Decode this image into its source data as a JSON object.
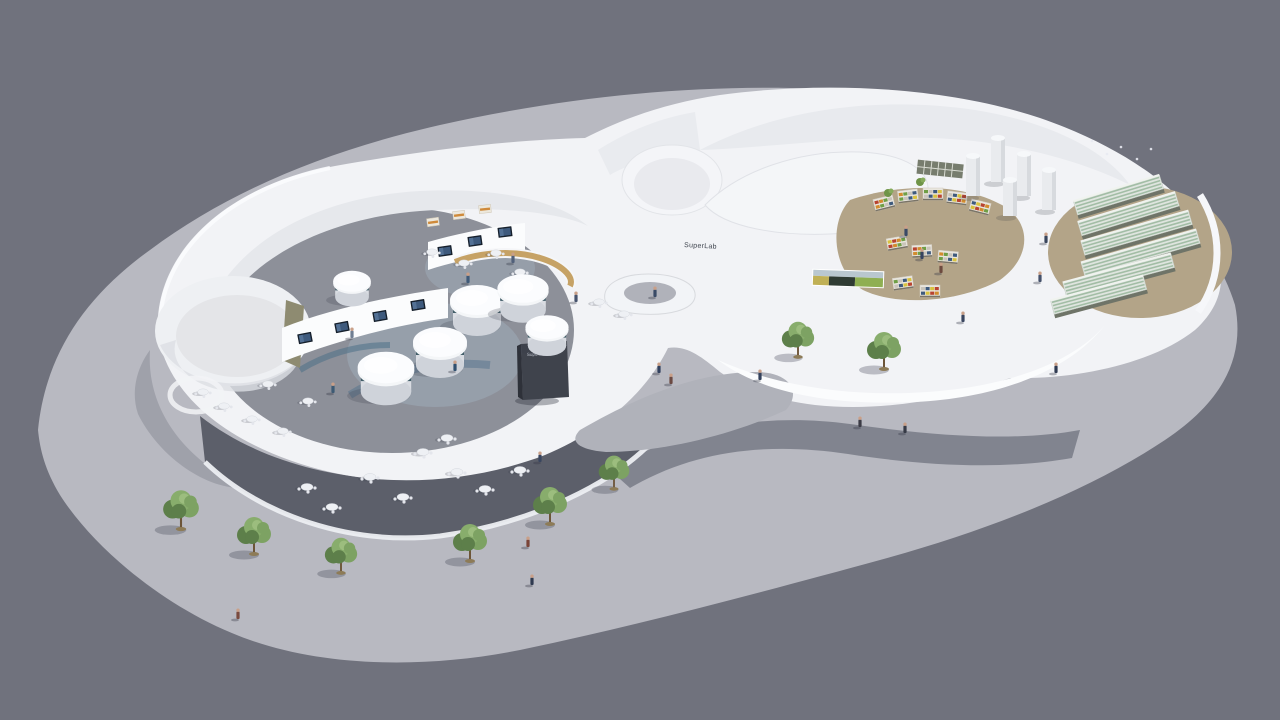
{
  "scene": {
    "title": "SuperLab pavilion aerial 3D render",
    "labels": {
      "building_wall_text": "SuperLab",
      "entrance_sign_text": "SuperLab"
    },
    "colors": {
      "background": "#70727d",
      "plaza": "#b8b9c1",
      "building_white": "#f2f3f6",
      "building_shade": "#e7e9ed",
      "courtyard_floor": "#8d9099",
      "forecourt_floor": "#b0b2ba",
      "terrace_dark": "#5c5f6a",
      "walkway_dark": "#7b7e89",
      "store_floor_tan": "#b3a488",
      "pod_band_teal": "#415d68",
      "screen_dark": "#16202c",
      "screen_glow": "#3e5a7d",
      "tree_green": "#7da263",
      "tree_green_dark": "#5d7f4a",
      "billboard_sky": "#b9c7cf",
      "billboard_dark": "#2f3b33",
      "billboard_green": "#8faf52",
      "billboard_yellow": "#c0b055",
      "wood_counter": "#c6a265",
      "olive_panel": "#8e8b71",
      "sign_face": "#3f434c"
    },
    "objects": {
      "trees": [
        {
          "x": 181,
          "y": 528,
          "s": 1.05
        },
        {
          "x": 254,
          "y": 553,
          "s": 1.0
        },
        {
          "x": 341,
          "y": 572,
          "s": 0.95
        },
        {
          "x": 470,
          "y": 560,
          "s": 1.0
        },
        {
          "x": 550,
          "y": 523,
          "s": 1.0
        },
        {
          "x": 614,
          "y": 488,
          "s": 0.9
        },
        {
          "x": 798,
          "y": 356,
          "s": 0.95
        },
        {
          "x": 884,
          "y": 368,
          "s": 1.0
        }
      ],
      "people": [
        {
          "x": 659,
          "y": 373,
          "c": "#31405e"
        },
        {
          "x": 671,
          "y": 384,
          "c": "#6b4a43"
        },
        {
          "x": 760,
          "y": 380,
          "c": "#33415c"
        },
        {
          "x": 860,
          "y": 427,
          "c": "#3b3b45"
        },
        {
          "x": 455,
          "y": 371,
          "c": "#305070"
        },
        {
          "x": 528,
          "y": 547,
          "c": "#7a4438"
        },
        {
          "x": 532,
          "y": 585,
          "c": "#2f3a50"
        },
        {
          "x": 238,
          "y": 619,
          "c": "#7a4a3e"
        },
        {
          "x": 1056,
          "y": 373,
          "c": "#2f3a52"
        },
        {
          "x": 905,
          "y": 433,
          "c": "#363a46"
        },
        {
          "x": 333,
          "y": 393,
          "c": "#3d5a74"
        },
        {
          "x": 352,
          "y": 338,
          "c": "#6f7e92"
        },
        {
          "x": 468,
          "y": 283,
          "c": "#3f5a78"
        },
        {
          "x": 513,
          "y": 263,
          "c": "#51607a"
        },
        {
          "x": 576,
          "y": 302,
          "c": "#46536d"
        },
        {
          "x": 655,
          "y": 297,
          "c": "#394a66"
        },
        {
          "x": 922,
          "y": 259,
          "c": "#36435f"
        },
        {
          "x": 941,
          "y": 273,
          "c": "#6d4a3f"
        },
        {
          "x": 906,
          "y": 236,
          "c": "#3a4a66"
        },
        {
          "x": 1046,
          "y": 243,
          "c": "#39455c"
        },
        {
          "x": 1040,
          "y": 282,
          "c": "#44506a"
        },
        {
          "x": 963,
          "y": 322,
          "c": "#39455f"
        },
        {
          "x": 540,
          "y": 462,
          "c": "#39455f"
        }
      ],
      "pods": [
        {
          "x": 477,
          "y": 311,
          "s": 1.0
        },
        {
          "x": 440,
          "y": 353,
          "s": 1.0
        },
        {
          "x": 523,
          "y": 299,
          "s": 0.95
        },
        {
          "x": 547,
          "y": 336,
          "s": 0.8
        },
        {
          "x": 386,
          "y": 379,
          "s": 1.05
        },
        {
          "x": 352,
          "y": 289,
          "s": 0.7
        }
      ],
      "terrace_tables": [
        {
          "x": 307,
          "y": 487
        },
        {
          "x": 332,
          "y": 507
        },
        {
          "x": 370,
          "y": 477
        },
        {
          "x": 403,
          "y": 497
        },
        {
          "x": 423,
          "y": 452
        },
        {
          "x": 447,
          "y": 438
        },
        {
          "x": 457,
          "y": 472
        },
        {
          "x": 485,
          "y": 489
        },
        {
          "x": 520,
          "y": 470
        }
      ],
      "courtyard_tables": [
        {
          "x": 203,
          "y": 392
        },
        {
          "x": 224,
          "y": 406
        },
        {
          "x": 252,
          "y": 419
        },
        {
          "x": 283,
          "y": 431
        },
        {
          "x": 308,
          "y": 401
        },
        {
          "x": 268,
          "y": 384
        },
        {
          "x": 432,
          "y": 252
        },
        {
          "x": 464,
          "y": 263
        },
        {
          "x": 496,
          "y": 253
        },
        {
          "x": 599,
          "y": 302
        },
        {
          "x": 624,
          "y": 314
        },
        {
          "x": 520,
          "y": 272
        }
      ],
      "screens": [
        {
          "x": 305,
          "y": 338,
          "r": -11
        },
        {
          "x": 342,
          "y": 327,
          "r": -11
        },
        {
          "x": 380,
          "y": 316,
          "r": -10
        },
        {
          "x": 418,
          "y": 305,
          "r": -9
        },
        {
          "x": 445,
          "y": 251,
          "r": -8
        },
        {
          "x": 475,
          "y": 241,
          "r": -8
        },
        {
          "x": 505,
          "y": 232,
          "r": -7
        }
      ],
      "display_cases": [
        {
          "x": 433,
          "y": 222,
          "r": -8
        },
        {
          "x": 459,
          "y": 215,
          "r": -7
        },
        {
          "x": 485,
          "y": 209,
          "r": -6
        }
      ],
      "columns": [
        {
          "x": 973,
          "y": 196,
          "h": 40
        },
        {
          "x": 998,
          "y": 182,
          "h": 44
        },
        {
          "x": 1024,
          "y": 196,
          "h": 42
        },
        {
          "x": 1049,
          "y": 210,
          "h": 40
        },
        {
          "x": 1010,
          "y": 216,
          "h": 36
        }
      ],
      "yard_racks": [
        {
          "x": 1120,
          "y": 200,
          "len": 90,
          "r": -17
        },
        {
          "x": 1130,
          "y": 219,
          "len": 102,
          "r": -17
        },
        {
          "x": 1138,
          "y": 238,
          "len": 112,
          "r": -16
        },
        {
          "x": 1142,
          "y": 258,
          "len": 120,
          "r": -16
        },
        {
          "x": 1120,
          "y": 280,
          "len": 112,
          "r": -15
        },
        {
          "x": 1100,
          "y": 300,
          "len": 96,
          "r": -15
        }
      ],
      "store_shelves": [
        {
          "x": 884,
          "y": 203,
          "r": -14
        },
        {
          "x": 908,
          "y": 196,
          "r": -7
        },
        {
          "x": 933,
          "y": 194,
          "r": 0
        },
        {
          "x": 957,
          "y": 198,
          "r": 7
        },
        {
          "x": 980,
          "y": 207,
          "r": 14
        },
        {
          "x": 897,
          "y": 243,
          "r": -10
        },
        {
          "x": 922,
          "y": 251,
          "r": -3
        },
        {
          "x": 948,
          "y": 257,
          "r": 5
        },
        {
          "x": 903,
          "y": 283,
          "r": -8
        },
        {
          "x": 930,
          "y": 291,
          "r": 0
        }
      ],
      "store_plants": [
        {
          "x": 920,
          "y": 182
        },
        {
          "x": 888,
          "y": 193
        }
      ],
      "birds": [
        {
          "x": 1092,
          "y": 141
        },
        {
          "x": 1107,
          "y": 154
        },
        {
          "x": 1121,
          "y": 147
        },
        {
          "x": 1137,
          "y": 159
        },
        {
          "x": 1151,
          "y": 149
        }
      ]
    }
  }
}
